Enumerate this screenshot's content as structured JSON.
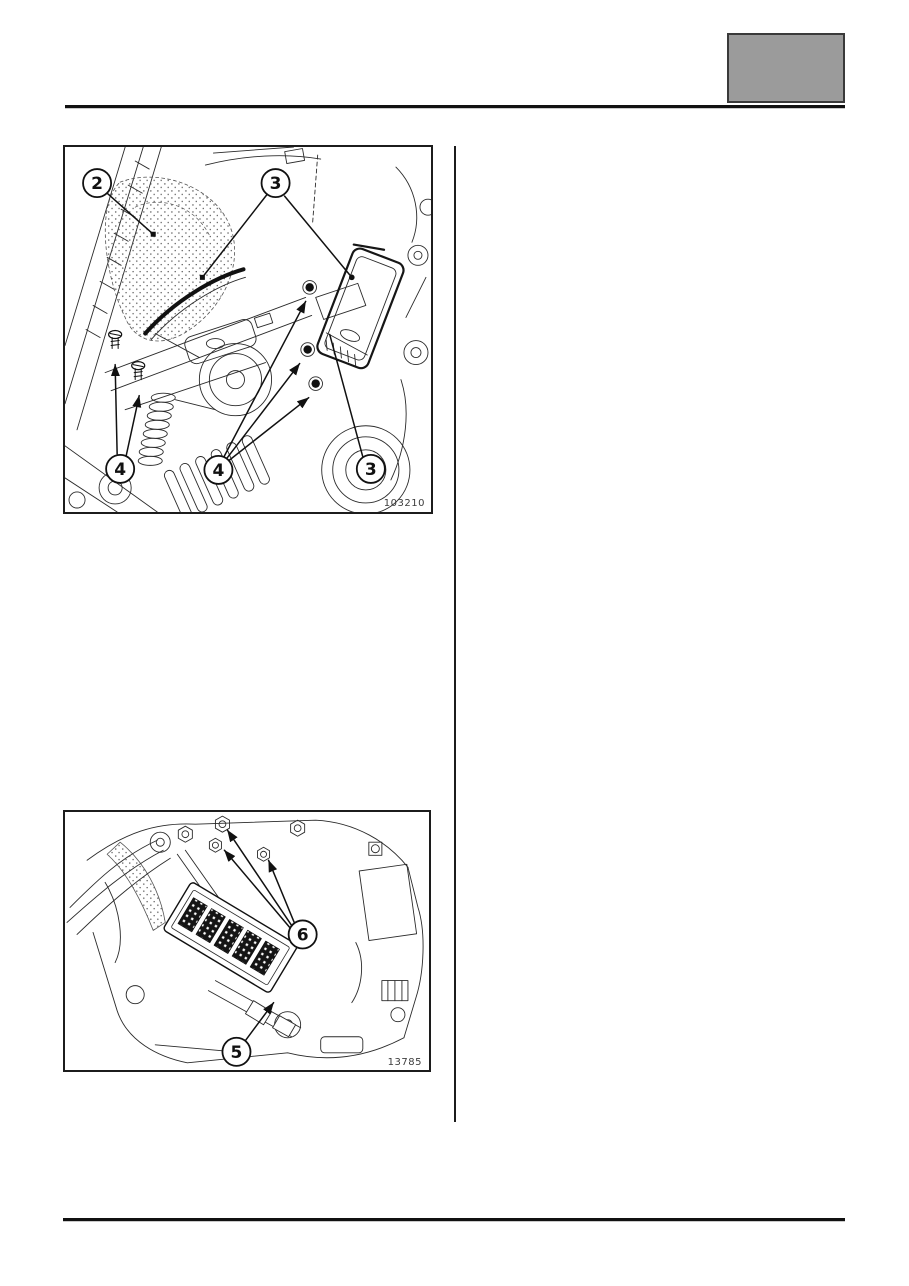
{
  "page": {
    "background": "#ffffff",
    "ink": "#1a1a1a"
  },
  "header": {
    "tab_box": {
      "fill": "#9b9b9b",
      "border": "#3a3a3a"
    }
  },
  "figures": [
    {
      "name": "engine-compartment-illustration",
      "image_number": "103210",
      "callouts": [
        {
          "label": "2"
        },
        {
          "label": "3"
        },
        {
          "label": "3"
        },
        {
          "label": "4"
        },
        {
          "label": "4"
        }
      ]
    },
    {
      "name": "gearbox-illustration",
      "image_number": "13785",
      "callouts": [
        {
          "label": "6"
        },
        {
          "label": "5"
        }
      ]
    }
  ]
}
